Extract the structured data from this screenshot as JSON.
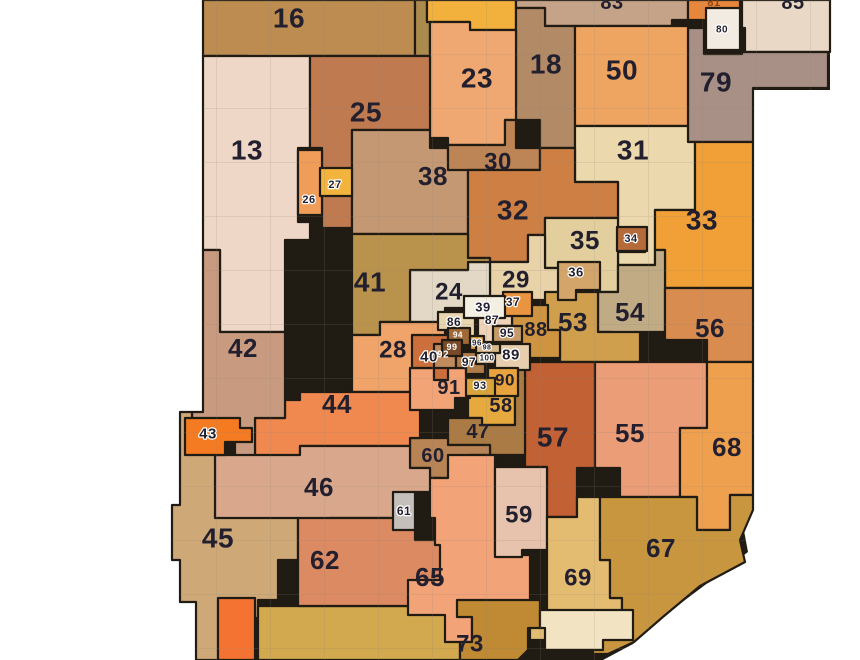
{
  "map_data": {
    "type": "choropleth-district-map",
    "canvas": {
      "width": 860,
      "height": 660
    },
    "colors": {
      "page_background": "#ffffff",
      "district_border": "#201b13",
      "county_line": "#8d8278",
      "default_label_color": "#221f2e",
      "white_label_color": "#ffffff"
    },
    "outline": "203,0 830,0 830,90 753,90 753,495 742,520 748,552 705,585 665,615 633,644 603,660 196,660 196,602 180,602 180,560 172,560 172,505 180,505 180,412 203,412",
    "districts": [
      {
        "number": "16",
        "fill": "#bd8c50",
        "points": "203,0 415,0 415,56 300,56 300,63 248,63 248,56 203,56",
        "label": {
          "text": "16",
          "x": 289,
          "y": 18,
          "size": 28
        }
      },
      {
        "number": "",
        "fill": "#ab8a4e",
        "points": "415,0 427,0 427,22 430,22 430,56 415,56"
      },
      {
        "number": "",
        "fill": "#f2b13d",
        "points": "427,0 516,0 516,30 470,30 470,22 427,22"
      },
      {
        "number": "83",
        "fill": "#c5a389",
        "points": "516,0 688,0 688,20 672,20 672,26 545,26 545,8 516,8",
        "clipped": true,
        "label": {
          "text": "83",
          "x": 612,
          "y": 3,
          "size": 20
        }
      },
      {
        "number": "81",
        "fill": "#e8873c",
        "points": "688,0 740,0 740,6 745,6 745,28 704,28 704,20 688,20",
        "clipped": true,
        "label": {
          "text": "81",
          "x": 714,
          "y": 3,
          "size": 11,
          "color": "#8a4412"
        }
      },
      {
        "number": "85",
        "fill": "#e9d8c6",
        "points": "742,0 830,0 830,52 745,52 745,28 742,28",
        "clipped": true,
        "label": {
          "text": "85",
          "x": 793,
          "y": 3,
          "size": 20
        }
      },
      {
        "number": "79",
        "fill": "#a89086",
        "points": "688,28 704,28 704,54 742,54 742,52 828,52 828,88 753,88 753,142 688,142",
        "label": {
          "text": "79",
          "x": 716,
          "y": 82,
          "size": 28
        }
      },
      {
        "number": "18",
        "fill": "#b38a66",
        "points": "516,8 545,8 545,26 575,26 575,148 540,148 540,120 516,120",
        "label": {
          "text": "18",
          "x": 546,
          "y": 64,
          "size": 28
        }
      },
      {
        "number": "50",
        "fill": "#efa562",
        "points": "575,26 688,26 688,126 575,126",
        "label": {
          "text": "50",
          "x": 622,
          "y": 70,
          "size": 28
        }
      },
      {
        "number": "23",
        "fill": "#f0a873",
        "points": "430,22 470,22 470,30 516,30 516,120 505,120 505,145 448,145 448,138 430,138",
        "label": {
          "text": "23",
          "x": 477,
          "y": 78,
          "size": 28
        }
      },
      {
        "number": "13",
        "fill": "#eed7c6",
        "points": "203,56 310,56 310,148 298,148 298,222 310,222 310,240 285,240 285,332 220,332 220,250 203,250",
        "label": {
          "text": "13",
          "x": 247,
          "y": 150,
          "size": 28
        }
      },
      {
        "number": "25",
        "fill": "#c07a50",
        "points": "310,56 430,56 430,130 352,130 352,228 322,228 322,148 310,148",
        "label": {
          "text": "25",
          "x": 366,
          "y": 112,
          "size": 28
        }
      },
      {
        "number": "38",
        "fill": "#c49872",
        "points": "352,130 430,130 430,148 448,148 448,160 468,160 468,234 352,234",
        "label": {
          "text": "38",
          "x": 433,
          "y": 176,
          "size": 26
        }
      },
      {
        "number": "30",
        "fill": "#bd8456",
        "points": "448,145 505,145 505,120 516,120 516,148 540,148 540,170 448,170",
        "label": {
          "text": "30",
          "x": 498,
          "y": 162,
          "size": 24
        }
      },
      {
        "number": "31",
        "fill": "#ecd8ad",
        "points": "575,126 688,126 688,142 695,142 695,210 655,210 655,265 618,265 618,182 575,182",
        "label": {
          "text": "31",
          "x": 633,
          "y": 150,
          "size": 28
        }
      },
      {
        "number": "32",
        "fill": "#cd7f44",
        "points": "468,170 540,170 540,148 575,148 575,182 618,182 618,218 545,218 545,235 528,235 528,262 490,262 490,258 468,258",
        "label": {
          "text": "32",
          "x": 513,
          "y": 210,
          "size": 28
        }
      },
      {
        "number": "33",
        "fill": "#f0a037",
        "points": "695,142 753,142 753,288 665,288 665,250 655,250 655,210 695,210",
        "label": {
          "text": "33",
          "x": 702,
          "y": 220,
          "size": 28
        }
      },
      {
        "number": "35",
        "fill": "#e3cf9e",
        "points": "545,218 618,218 618,228 645,228 645,252 618,252 618,292 560,292 560,268 545,268",
        "label": {
          "text": "35",
          "x": 585,
          "y": 240,
          "size": 26
        }
      },
      {
        "number": "29",
        "fill": "#e8d2a8",
        "points": "490,262 528,262 528,235 545,235 545,268 560,268 560,300 490,300",
        "label": {
          "text": "29",
          "x": 516,
          "y": 280,
          "size": 24
        }
      },
      {
        "number": "24",
        "fill": "#e2d8c5",
        "points": "410,270 468,270 468,262 490,262 490,300 480,300 480,318 465,318 465,308 445,308 445,322 410,322",
        "label": {
          "text": "24",
          "x": 449,
          "y": 292,
          "size": 24
        }
      },
      {
        "number": "41",
        "fill": "#b9924c",
        "points": "352,234 468,234 468,258 490,258 490,262 468,262 468,270 410,270 410,322 380,322 380,335 352,335",
        "label": {
          "text": "41",
          "x": 370,
          "y": 282,
          "size": 28
        }
      },
      {
        "number": "54",
        "fill": "#c0ab85",
        "points": "598,292 618,292 618,265 655,265 655,250 665,250 665,332 640,332 640,345 612,345 612,332 598,332",
        "label": {
          "text": "54",
          "x": 630,
          "y": 312,
          "size": 26
        }
      },
      {
        "number": "53",
        "fill": "#cf9f4e",
        "points": "545,292 598,292 598,332 640,332 640,362 560,362 560,330 545,330",
        "label": {
          "text": "53",
          "x": 573,
          "y": 322,
          "size": 26
        }
      },
      {
        "number": "56",
        "fill": "#d98c50",
        "points": "665,288 753,288 753,362 707,362 707,340 665,340",
        "label": {
          "text": "56",
          "x": 710,
          "y": 328,
          "size": 26
        }
      },
      {
        "number": "88",
        "fill": "#cf9440",
        "points": "512,305 548,305 548,330 560,330 560,358 512,358",
        "label": {
          "text": "88",
          "x": 536,
          "y": 330,
          "size": 20
        }
      },
      {
        "number": "57",
        "fill": "#c16134",
        "points": "525,362 595,362 595,468 577,468 577,517 547,517 547,467 525,467",
        "label": {
          "text": "57",
          "x": 553,
          "y": 437,
          "size": 28
        }
      },
      {
        "number": "55",
        "fill": "#eb9d77",
        "points": "595,362 707,362 707,428 680,428 680,497 620,497 620,468 595,468",
        "label": {
          "text": "55",
          "x": 630,
          "y": 433,
          "size": 26
        }
      },
      {
        "number": "68",
        "fill": "#efa04f",
        "points": "707,362 753,362 753,495 730,495 730,530 697,530 697,497 680,497 680,428 707,428",
        "label": {
          "text": "68",
          "x": 727,
          "y": 447,
          "size": 26
        }
      },
      {
        "number": "58",
        "fill": "#e5a93e",
        "points": "468,388 515,388 515,425 482,425 482,418 468,418",
        "label": {
          "text": "58",
          "x": 501,
          "y": 406,
          "size": 20
        }
      },
      {
        "number": "47",
        "fill": "#ab7b45",
        "points": "448,418 482,418 482,425 515,425 515,358 525,358 525,455 490,455 490,445 448,445",
        "label": {
          "text": "47",
          "x": 478,
          "y": 432,
          "size": 20
        }
      },
      {
        "number": "60",
        "fill": "#b88355",
        "points": "410,438 448,438 448,445 490,445 490,455 470,455 470,478 430,478 430,468 410,468",
        "label": {
          "text": "60",
          "x": 433,
          "y": 456,
          "size": 20
        }
      },
      {
        "number": "28",
        "fill": "#f0a469",
        "points": "352,335 380,335 380,322 445,322 445,340 415,340 415,375 412,375 412,392 352,392",
        "label": {
          "text": "28",
          "x": 393,
          "y": 350,
          "size": 24
        }
      },
      {
        "number": "44",
        "fill": "#ef8950",
        "points": "300,392 412,392 412,408 420,408 420,438 410,438 410,446 300,446 300,458 255,458 255,418 285,418 285,400 300,400",
        "label": {
          "text": "44",
          "x": 337,
          "y": 404,
          "size": 26
        }
      },
      {
        "number": "42",
        "fill": "#c89a80",
        "points": "203,250 220,250 220,332 285,332 285,418 255,418 255,458 235,458 235,440 210,440 210,452 192,452 192,412 203,412",
        "label": {
          "text": "42",
          "x": 243,
          "y": 348,
          "size": 26
        }
      },
      {
        "number": "46",
        "fill": "#d9a88c",
        "points": "215,455 300,455 300,446 410,446 410,468 430,468 430,478 440,478 440,492 415,492 415,518 330,518 330,520 215,520",
        "label": {
          "text": "46",
          "x": 319,
          "y": 487,
          "size": 26
        }
      },
      {
        "number": "45",
        "fill": "#cfa878",
        "points": "172,505 180,505 180,412 192,412 192,452 215,452 215,518 298,518 298,560 278,560 278,600 258,600 258,618 238,618 238,660 196,660 196,602 180,602 180,560 172,560",
        "label": {
          "text": "45",
          "x": 218,
          "y": 538,
          "size": 28
        }
      },
      {
        "number": "",
        "fill": "#d3a94f",
        "points": "258,606 457,606 457,617 472,617 472,642 460,642 460,660 258,660"
      },
      {
        "number": "62",
        "fill": "#dc8a61",
        "points": "298,518 415,518 415,540 448,540 448,578 462,578 462,606 298,606",
        "label": {
          "text": "62",
          "x": 325,
          "y": 560,
          "size": 26
        }
      },
      {
        "number": "65",
        "fill": "#f2a378",
        "points": "430,478 448,478 448,455 495,455 495,555 530,555 530,617 472,617 472,642 445,642 445,615 408,615 408,580 440,580 440,545 435,545 435,518 430,518",
        "label": {
          "text": "65",
          "x": 430,
          "y": 577,
          "size": 26
        }
      },
      {
        "number": "59",
        "fill": "#e7c3ad",
        "points": "495,467 547,467 547,550 522,550 522,557 495,557",
        "label": {
          "text": "59",
          "x": 519,
          "y": 515,
          "size": 24
        }
      },
      {
        "number": "69",
        "fill": "#e3bc72",
        "points": "547,517 577,517 577,497 600,497 600,560 610,560 610,598 622,598 622,625 593,625 593,650 548,650 548,640 530,640 530,617 547,617",
        "label": {
          "text": "69",
          "x": 578,
          "y": 578,
          "size": 24
        }
      },
      {
        "number": "67",
        "fill": "#c8963f",
        "points": "600,497 697,497 697,530 730,530 730,495 753,495 753,510 740,540 745,562 700,586 664,616 634,642 608,654 593,654 593,625 622,625 622,598 610,598 610,560 600,560",
        "label": {
          "text": "67",
          "x": 661,
          "y": 548,
          "size": 26
        }
      },
      {
        "number": "73",
        "fill": "#bf8a33",
        "points": "457,600 540,600 540,628 528,628 528,650 518,660 460,660 460,642 472,642 472,617 457,617",
        "label": {
          "text": "73",
          "x": 470,
          "y": 644,
          "size": 24
        }
      },
      {
        "number": "",
        "fill": "#f2e3c2",
        "points": "540,610 633,610 633,640 603,640 603,650 545,650 545,628 540,628"
      },
      {
        "number": "",
        "fill": "#f47333",
        "points": "218,598 255,598 255,660 218,660"
      },
      {
        "number": "91",
        "fill": "#f3a477",
        "points": "410,368 466,368 466,378 470,378 470,398 455,398 455,410 410,410",
        "label": {
          "text": "91",
          "x": 449,
          "y": 388,
          "size": 20
        }
      },
      {
        "number": "40",
        "fill": "#cc6f3c",
        "points": "412,335 448,335 448,380 434,380 434,368 412,368",
        "label": {
          "text": "40",
          "x": 429,
          "y": 357,
          "size": 15,
          "halo": true
        }
      },
      {
        "number": "92",
        "fill": "#c08a5c",
        "points": "434,344 456,344 456,368 434,368",
        "label": {
          "text": "92",
          "x": 443,
          "y": 355,
          "size": 10,
          "color": "#ffffff"
        }
      },
      {
        "number": "97",
        "fill": "#b07c4a",
        "points": "456,352 485,352 485,374 466,374 466,368 456,368",
        "label": {
          "text": "97",
          "x": 469,
          "y": 362,
          "size": 12,
          "halo": true
        }
      },
      {
        "number": "86",
        "fill": "#e8d6b0",
        "points": "438,312 475,312 475,338 460,338 460,330 438,330",
        "label": {
          "text": "86",
          "x": 454,
          "y": 322,
          "size": 12,
          "halo": true
        }
      },
      {
        "number": "87",
        "fill": "#eed3b8",
        "points": "478,308 512,308 512,326 495,326 495,342 478,342",
        "label": {
          "text": "87",
          "x": 492,
          "y": 320,
          "size": 12,
          "halo": true
        }
      },
      {
        "number": "95",
        "fill": "#c59a6a",
        "points": "493,326 522,326 522,342 493,342",
        "label": {
          "text": "95",
          "x": 507,
          "y": 333,
          "size": 12,
          "halo": true
        }
      },
      {
        "number": "100",
        "fill": "#dcc09a",
        "points": "476,352 502,352 502,364 476,364",
        "label": {
          "text": "100",
          "x": 487,
          "y": 358,
          "size": 8,
          "halo": true
        }
      },
      {
        "number": "89",
        "fill": "#e7cfae",
        "points": "495,344 530,344 530,370 495,370",
        "label": {
          "text": "89",
          "x": 511,
          "y": 355,
          "size": 15,
          "halo": true
        }
      },
      {
        "number": "90",
        "fill": "#e8a33e",
        "points": "488,368 518,368 518,396 488,396",
        "label": {
          "text": "90",
          "x": 505,
          "y": 380,
          "size": 17
        }
      },
      {
        "number": "93",
        "fill": "#d9a33c",
        "points": "466,378 495,378 495,396 466,396",
        "label": {
          "text": "93",
          "x": 480,
          "y": 386,
          "size": 11,
          "halo": true
        }
      },
      {
        "number": "26",
        "fill": "#f09d5a",
        "points": "298,150 322,150 322,215 298,215",
        "label": {
          "text": "26",
          "x": 309,
          "y": 200,
          "size": 11,
          "halo": true
        }
      },
      {
        "number": "27",
        "fill": "#f3b43e",
        "points": "320,168 352,168 352,196 320,196",
        "label": {
          "text": "27",
          "x": 335,
          "y": 185,
          "size": 11,
          "halo": true
        }
      },
      {
        "number": "80",
        "fill": "#f2ebe2",
        "points": "706,8 740,8 740,50 706,50",
        "label": {
          "text": "80",
          "x": 722,
          "y": 30,
          "size": 10,
          "halo": true
        }
      },
      {
        "number": "34",
        "fill": "#b56a3a",
        "points": "617,227 647,227 647,251 617,251",
        "label": {
          "text": "34",
          "x": 631,
          "y": 239,
          "size": 11,
          "halo": true
        }
      },
      {
        "number": "36",
        "fill": "#d4a56a",
        "points": "558,262 600,262 600,290 576,290 576,300 558,300",
        "label": {
          "text": "36",
          "x": 576,
          "y": 272,
          "size": 13,
          "halo": true
        }
      },
      {
        "number": "37",
        "fill": "#e89440",
        "points": "503,292 532,292 532,316 503,316",
        "label": {
          "text": "37",
          "x": 513,
          "y": 302,
          "size": 12,
          "halo": true
        }
      },
      {
        "number": "39",
        "fill": "#f4efe3",
        "points": "464,296 505,296 505,318 464,318",
        "label": {
          "text": "39",
          "x": 483,
          "y": 307,
          "size": 13,
          "halo": true
        }
      },
      {
        "number": "61",
        "fill": "#c4bfba",
        "points": "393,492 415,492 415,530 393,530",
        "label": {
          "text": "61",
          "x": 404,
          "y": 511,
          "size": 12,
          "halo": true
        }
      },
      {
        "number": "43",
        "fill": "#f47b21",
        "points": "185,418 240,418 240,428 252,428 252,442 225,442 225,455 185,455",
        "label": {
          "text": "43",
          "x": 208,
          "y": 434,
          "size": 15,
          "halo": true
        }
      },
      {
        "number": "94",
        "fill": "#a06a38",
        "points": "448,328 470,328 470,345 448,345",
        "label": {
          "text": "94",
          "x": 458,
          "y": 335,
          "size": 8,
          "color": "#ffffff"
        }
      },
      {
        "number": "96",
        "fill": "#e0a243",
        "points": "470,336 484,336 484,350 470,350",
        "label": {
          "text": "96",
          "x": 477,
          "y": 343,
          "size": 8,
          "halo": true
        }
      },
      {
        "number": "98",
        "fill": "#d8b88a",
        "points": "476,344 500,344 500,353 476,353",
        "label": {
          "text": "98",
          "x": 487,
          "y": 348,
          "size": 7,
          "halo": true
        }
      },
      {
        "number": "99",
        "fill": "#7a4a28",
        "points": "442,340 462,340 462,356 442,356",
        "label": {
          "text": "99",
          "x": 452,
          "y": 347,
          "size": 9,
          "color": "#ffffff"
        }
      }
    ]
  }
}
